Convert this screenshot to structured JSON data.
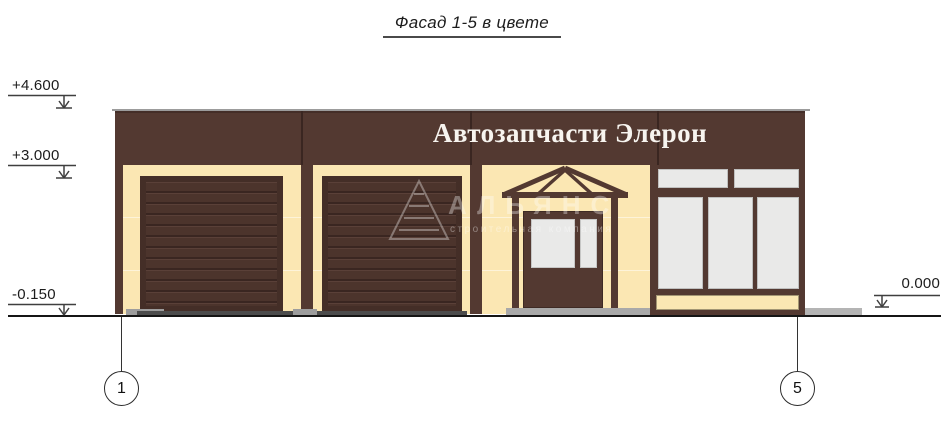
{
  "title": "Фасад 1-5 в цвете",
  "building": {
    "sign_text": "Автозапчасти Элерон"
  },
  "elevation_marks": {
    "parapet_top": "+4.600",
    "sign_band_bottom": "+3.000",
    "ground_left": "-0.150",
    "ground_right": "0.000"
  },
  "axes": {
    "left": "1",
    "right": "5"
  },
  "watermark": {
    "name": "АЛЬЯНС",
    "subtitle": "строительная компания"
  },
  "colors": {
    "band_brown": "#533931",
    "frame_brown": "#442e27",
    "slat_base": "#4c342c",
    "slat_dark": "#3a2621",
    "slat_light": "#5a4038",
    "wall_cream": "#fbe7b3",
    "glass_grey": "#e9e9e8",
    "step_grey": "#a9a9a9",
    "apron_dark": "#4c4c4c",
    "pad_grey": "#9d9d9d",
    "sidewalk_grey": "#b4b4b4"
  }
}
